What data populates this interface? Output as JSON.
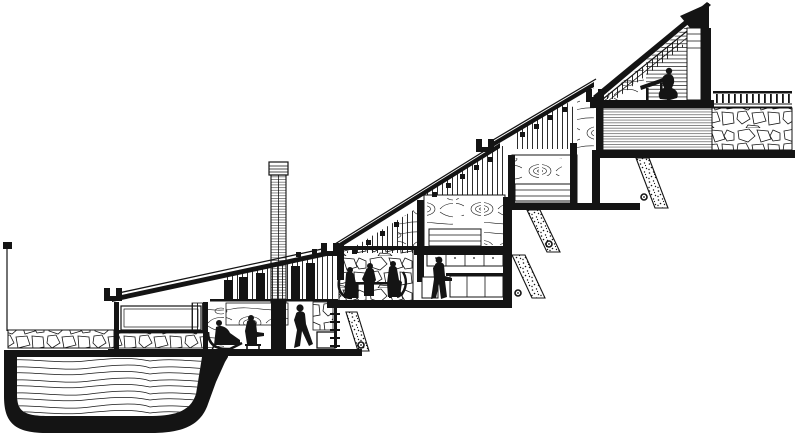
{
  "canvas": {
    "width": 800,
    "height": 436
  },
  "colors": {
    "ink": "#141414",
    "paper": "#ffffff"
  },
  "drawing": {
    "type": "architectural-section-drawing",
    "subject": "stepped hillside house in cross-section",
    "levels": [
      {
        "name": "swimming-pool"
      },
      {
        "name": "entry-carport-wing"
      },
      {
        "name": "living-room"
      },
      {
        "name": "dining-room"
      },
      {
        "name": "kitchen"
      },
      {
        "name": "bedroom-1"
      },
      {
        "name": "bedroom-2"
      },
      {
        "name": "studio"
      },
      {
        "name": "roof-terrace"
      }
    ],
    "figures": [
      {
        "name": "lounging-figure",
        "room": "living-room"
      },
      {
        "name": "seated-figure",
        "room": "living-room"
      },
      {
        "name": "walking-figure",
        "room": "living-room"
      },
      {
        "name": "diner-left",
        "room": "dining-room"
      },
      {
        "name": "diner-center",
        "room": "dining-room"
      },
      {
        "name": "diner-right",
        "room": "dining-room"
      },
      {
        "name": "standing-figure",
        "room": "kitchen"
      },
      {
        "name": "drafting-figure",
        "room": "studio"
      }
    ],
    "figure_count": 8,
    "features": [
      "chimney",
      "fireplace-column",
      "clerestory-slat-windows",
      "stone-rubble-walls",
      "wood-grain-panels",
      "horizontal-siding",
      "stepped-shed-roofs",
      "retaining-walls",
      "drain-circles",
      "pool-water-lines",
      "terrace-railing",
      "dining-table",
      "kitchen-cabinets",
      "drafting-desk",
      "ladder-stair"
    ],
    "baluster_count": 13,
    "drain_circle_count": 4,
    "roof_step_count": 4
  }
}
